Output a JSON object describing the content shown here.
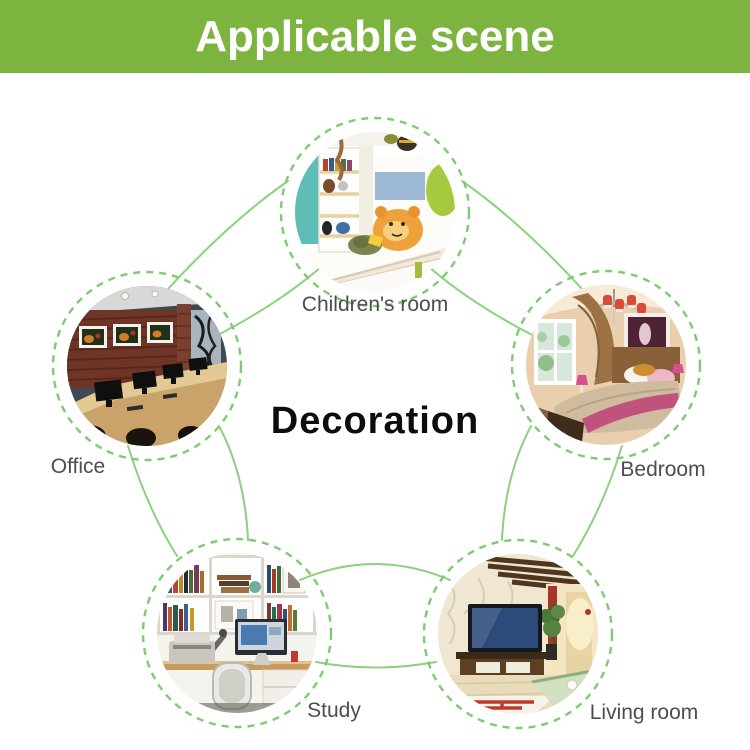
{
  "header": {
    "title": "Applicable scene"
  },
  "center": {
    "title": "Decoration"
  },
  "scenes": [
    {
      "id": "children-room",
      "label": "Children's room"
    },
    {
      "id": "office",
      "label": "Office"
    },
    {
      "id": "bedroom",
      "label": "Bedroom"
    },
    {
      "id": "study",
      "label": "Study"
    },
    {
      "id": "living-room",
      "label": "Living room"
    }
  ],
  "colors": {
    "header_bg": "#7db43f",
    "connector": "#8bd17f",
    "connector_dash": "#7ecb72",
    "label_text": "#4d4d4d",
    "center_text": "#0d0d0d"
  }
}
